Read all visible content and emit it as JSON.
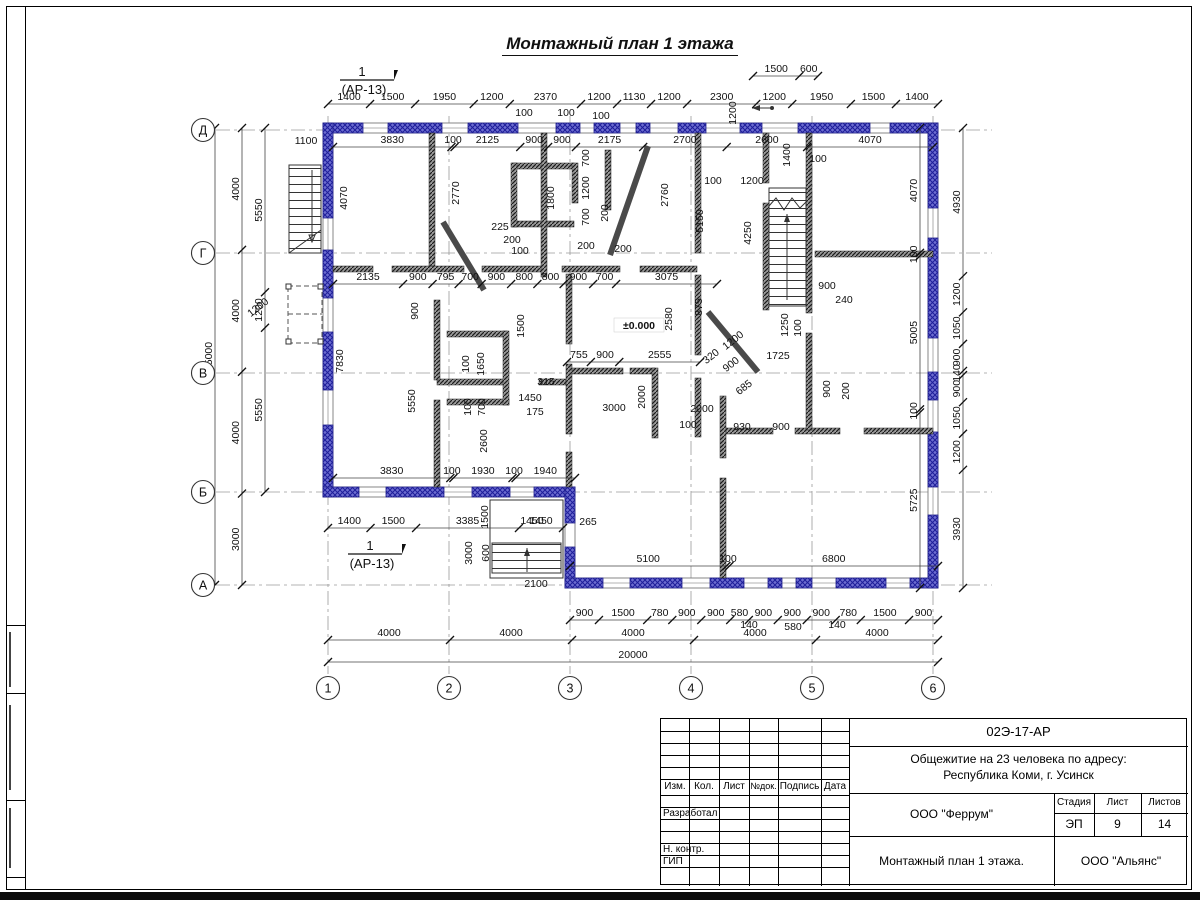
{
  "page": {
    "title": "Монтажный план 1 этажа"
  },
  "plan": {
    "row_axes": [
      "Д",
      "Г",
      "В",
      "Б",
      "А"
    ],
    "col_axes": [
      "1",
      "2",
      "3",
      "4",
      "5",
      "6"
    ],
    "level_mark": "±0.000",
    "section_mark": {
      "num": "1",
      "ref": "(АР-13)"
    },
    "entry_arrow": "entrance-direction",
    "chains": {
      "top_upper": [
        "1500",
        "600"
      ],
      "top_main": [
        "1400",
        "1500",
        "1950",
        "1200",
        "2370",
        "1200",
        "1130",
        "1200",
        "2300",
        "1200",
        "1950",
        "1500",
        "1400"
      ],
      "top_inner": [
        "3830",
        "100",
        "2125",
        "900",
        "900",
        "2175",
        "2700",
        "2600",
        "4070"
      ],
      "mid_inner": [
        "2135",
        "900",
        "795",
        "700",
        "900",
        "800",
        "800",
        "900",
        "700",
        "3075"
      ],
      "v_row": [
        "755",
        "900",
        "2555"
      ],
      "low_inner": [
        "3830",
        "100",
        "1930",
        "100",
        "1940"
      ],
      "low_inner2": [
        "5100",
        "100",
        "6800"
      ],
      "under_b": [
        "1400",
        "1500",
        "3385",
        "1450"
      ],
      "bottom_small": [
        "900",
        "1500",
        "780",
        "900",
        "900",
        "580",
        "900",
        "900",
        "900",
        "780",
        "1500",
        "900"
      ],
      "bottom_axes": [
        "4000",
        "4000",
        "4000",
        "4000",
        "4000"
      ],
      "bottom_total": [
        "20000"
      ],
      "left_total": [
        "15000"
      ],
      "left_axes": [
        "4000",
        "4000",
        "4000",
        "3000"
      ],
      "left_inner": [
        "5550",
        "1200",
        "5550"
      ],
      "right_inner": [
        "4070",
        "100",
        "5005",
        "100",
        "5725"
      ],
      "right_outer": [
        "4930",
        "1200",
        "1050",
        "900",
        "140",
        "900",
        "1050",
        "1200",
        "3930"
      ]
    },
    "labels": [
      "1100",
      "100",
      "100",
      "100",
      "100",
      "1200",
      "100",
      "4070",
      "2770",
      "1800",
      "700",
      "1200",
      "700",
      "200",
      "2760",
      "1400",
      "4250",
      "5150",
      "225",
      "200",
      "100",
      "200",
      "200",
      "900",
      "1650",
      "100",
      "100",
      "700",
      "315",
      "1450",
      "175",
      "2580",
      "875",
      "1250",
      "100",
      "900",
      "240",
      "1200",
      "320",
      "900",
      "685",
      "1725",
      "2000",
      "2000",
      "100",
      "930",
      "900",
      "3000",
      "900",
      "200",
      "7830",
      "5550",
      "2600",
      "1500",
      "3000",
      "600",
      "2100",
      "1450",
      "265",
      "140",
      "580",
      "140",
      "1200",
      "1500",
      "1200"
    ]
  },
  "titleblock": {
    "doc_number": "02Э-17-АР",
    "project_line1": "Общежитие на 23 человека по адресу:",
    "project_line2": "Республика Коми, г. Усинск",
    "org": "ООО \"Феррум\"",
    "sheet_title": "Монтажный план 1 этажа.",
    "org2": "ООО \"Альянс\"",
    "stage_label": "Стадия",
    "sheet_label": "Лист",
    "sheets_label": "Листов",
    "stage": "ЭП",
    "sheet": "9",
    "sheets": "14",
    "cols": [
      "Изм.",
      "Кол.",
      "Лист",
      "№док.",
      "Подпись",
      "Дата"
    ],
    "rows": [
      "Разработал",
      "Н. контр.",
      "ГИП"
    ]
  }
}
